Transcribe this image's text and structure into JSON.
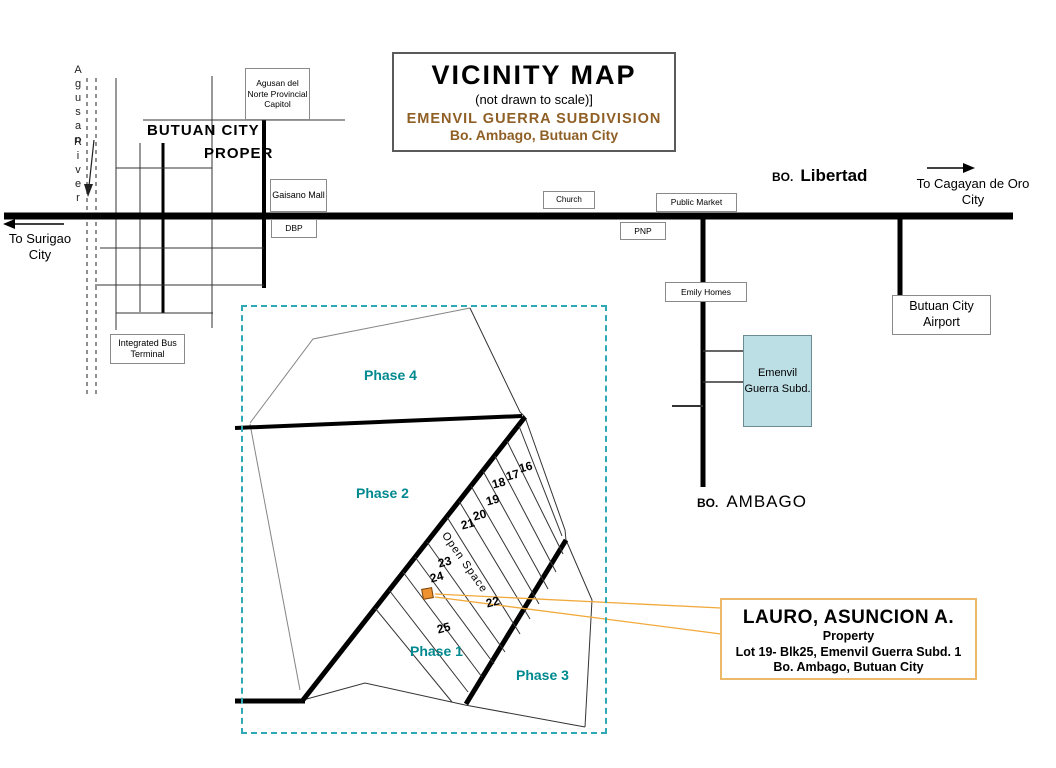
{
  "colors": {
    "phase_label": "#00898F",
    "dashed_border": "#2FA8B5",
    "title_brown": "#8F5F25",
    "subd_box_fill": "#BCDEE5",
    "callout_border": "#ECB869",
    "marker_fill": "#EE9230",
    "marker_border": "#7A4A10",
    "leader_line": "#F2A93B"
  },
  "title_box": {
    "title": "VICINITY MAP",
    "subtitle": "(not drawn to scale)]",
    "subdivision": "EMENVIL GUERRA SUBDIVISION",
    "location": "Bo. Ambago, Butuan City"
  },
  "river": {
    "word1": "Agusan",
    "word2": "River"
  },
  "city_proper": {
    "line1": "BUTUAN CITY",
    "line2": "PROPER"
  },
  "landmarks": {
    "capitol": "Agusan del Norte Provincial Capitol",
    "gaisano": "Gaisano Mall",
    "dbp": "DBP",
    "church": "Church",
    "pnp": "PNP",
    "public_market": "Public Market",
    "emily_homes": "Emily Homes",
    "bus_terminal": "Integrated Bus Terminal",
    "airport": "Butuan City Airport",
    "emenvil_subd": "Emenvil Guerra Subd."
  },
  "barangays": {
    "libertad_prefix": "BO.",
    "libertad": "Libertad",
    "ambago_prefix": "BO.",
    "ambago": "AMBAGO"
  },
  "directions": {
    "cagayan_line1": "To  Cagayan de Oro",
    "cagayan_line2": "City",
    "surigao_line1": "To Surigao",
    "surigao_line2": "City"
  },
  "subdivision_map": {
    "phase4": "Phase 4",
    "phase2": "Phase 2",
    "phase1": "Phase 1",
    "phase3": "Phase 3",
    "open_space": "Open Space",
    "lots": [
      "16",
      "17",
      "18",
      "19",
      "20",
      "21",
      "22",
      "23",
      "24",
      "25"
    ]
  },
  "callout": {
    "name": "LAURO, ASUNCION A.",
    "type": "Property",
    "line3": "Lot 19- Blk25,  Emenvil Guerra Subd. 1",
    "line4": "Bo. Ambago, Butuan City"
  }
}
